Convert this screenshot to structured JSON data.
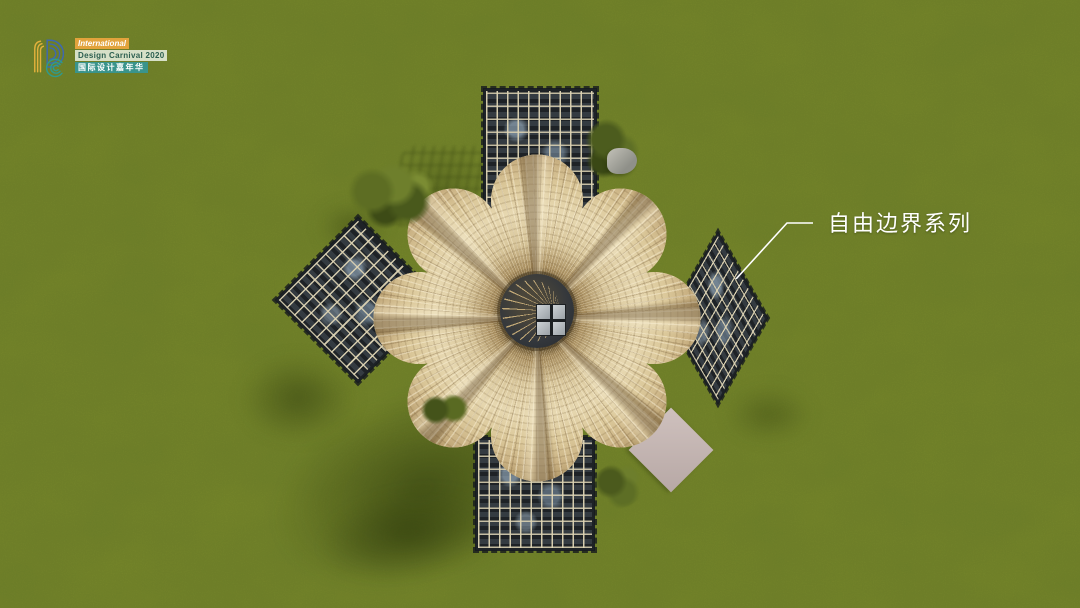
{
  "logo": {
    "line1": "International",
    "line2": "Design Carnival 2020",
    "line3": "国际设计嘉年华"
  },
  "annotation": {
    "label": "自由边界系列"
  },
  "palette": {
    "grass": "#7d8c2b",
    "grass_shadow": "#46570f",
    "canopy_rattan": "#d9c79c",
    "trellis_frame": "#1d2226",
    "trellis_grid_line": "#ded4b4",
    "ramp": "#c6b7b4",
    "label_text": "#ffffff",
    "logo_yellow": "#e3b13c",
    "logo_blue": "#3e68b0",
    "logo_teal": "#2f9a8c",
    "logo_tag_orange": "#e2a33c",
    "logo_tag_pale": "#dfe8d6",
    "logo_tag_teal": "#3a948c"
  }
}
